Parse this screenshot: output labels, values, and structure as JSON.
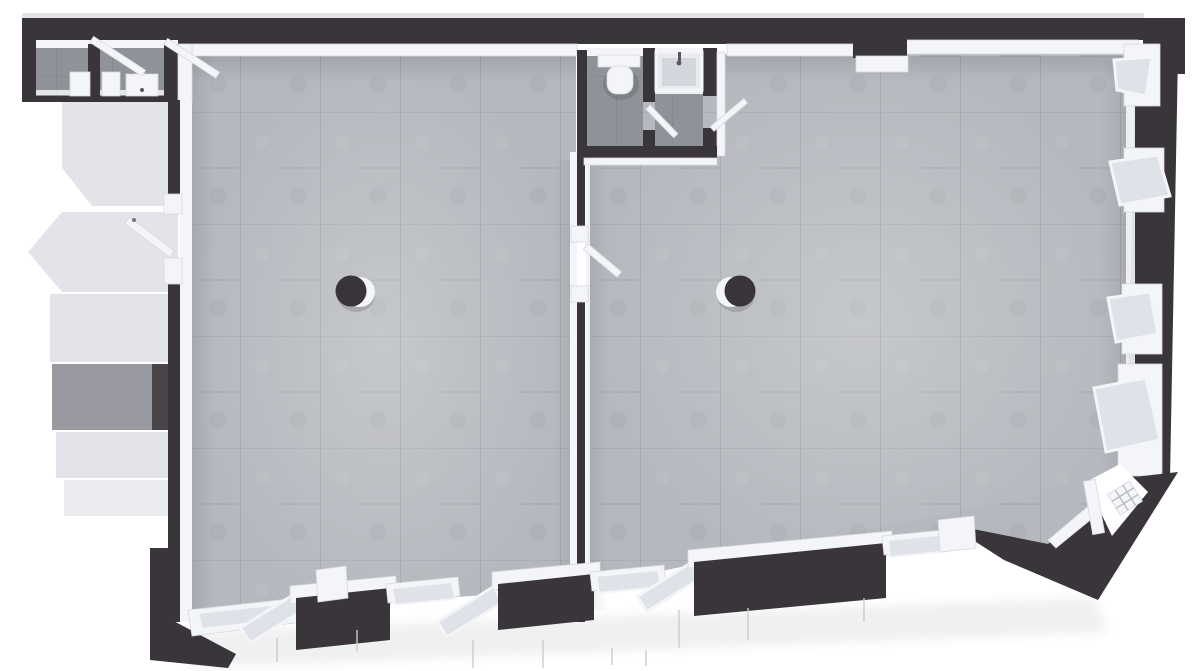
{
  "title": "3D top-down floor plan render of a two-hall commercial space",
  "colors": {
    "background": "#ffffff",
    "wall": "#3a353a",
    "wallFace": "#4b4650",
    "trim": "#f4f5f8",
    "trimShadow": "#d7d9de",
    "glass": "#dfe2e8",
    "floorLight": "#b5b8be",
    "floorDark": "#8f9298",
    "exterior": "#e2e4ea",
    "exteriorMid": "#999aa1",
    "column": "#39343a"
  },
  "scene": {
    "view": "top-down-3d-render",
    "rooms": [
      {
        "id": "west-hall",
        "floor": "light-concrete-tile",
        "features": [
          "round-column"
        ]
      },
      {
        "id": "east-hall",
        "floor": "light-concrete-tile",
        "features": [
          "round-column"
        ]
      },
      {
        "id": "wc-cell",
        "floor": "dark-concrete-tile",
        "fixtures": [
          "wall-hung-toilet"
        ]
      },
      {
        "id": "shower-cell",
        "floor": "dark-concrete-tile",
        "fixtures": [
          "shower-tray-with-faucet"
        ]
      },
      {
        "id": "service-cells-northwest",
        "floor": "dark-concrete-tile",
        "fixtures": [
          "cabinet",
          "cabinet",
          "washbasin-cabinet"
        ]
      },
      {
        "id": "exterior-landing-west",
        "floor": "exterior-light",
        "features": [
          "balcony-slab"
        ]
      }
    ],
    "openings": {
      "interior_door_leaves_open": 5,
      "exterior_door_leaves_open": 2,
      "bottom_wall_open_sashes": 3,
      "bottom_wall_closed_panes": 4,
      "right_wall_open_sashes": 4,
      "chamfered_corner_door": 1
    },
    "columns": 2
  }
}
